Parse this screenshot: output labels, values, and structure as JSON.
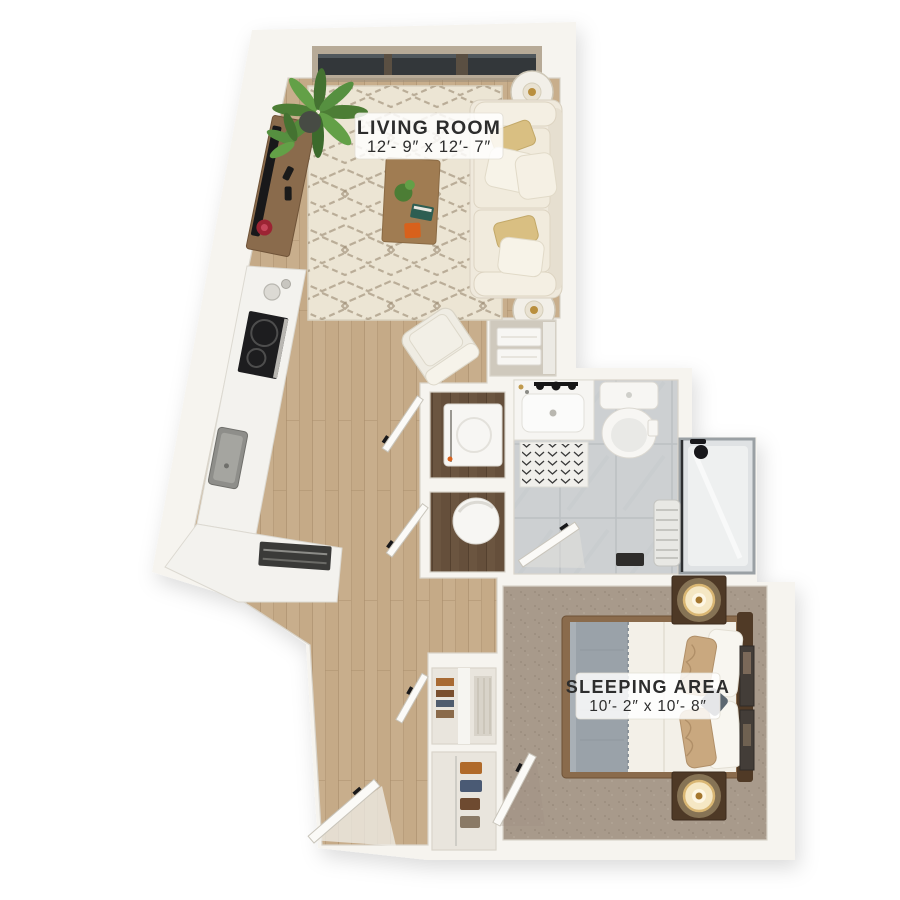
{
  "labels": {
    "living_room": {
      "name": "LIVING ROOM",
      "size": "12′- 9″ x 12′- 7″"
    },
    "sleeping_area": {
      "name": "SLEEPING AREA",
      "size": "10′- 2″ x 10′- 8″"
    }
  },
  "colors": {
    "background": "#ffffff",
    "wall": "#f6f4ef",
    "wall_edge": "#d9d4ca",
    "wood_floor": "#c8ae8c",
    "wood_seam": "#ab906e",
    "rug": "#ece5d4",
    "rug_pattern": "#9b8a72",
    "carpet": "#a89a8b",
    "carpet_dot": "#968878",
    "tile": "#cdd0d2",
    "tile_grout": "#bcc0c3",
    "counter": "#f3f2ee",
    "appliance_dark": "#1d1d1f",
    "fixture_white": "#f7f6f3",
    "furniture_wood": "#8a6b4c",
    "dark_wood": "#503a26",
    "niche_wood": "#6b5540",
    "sofa": "#efe9dc",
    "pillow_gold": "#d9bf82",
    "blanket_gray": "#9aa2a9",
    "pillow_tan": "#c9a87f",
    "plant_green": "#4c7d35",
    "accent_orange": "#d8611c",
    "accent_red": "#9c2433",
    "lamp_gold": "#d9b673",
    "glass_dark": "#33373a",
    "window_frame": "#b7aa97",
    "label_text": "#2d2d2d"
  },
  "objects": [
    "window-wall",
    "potted-plant",
    "tv-console",
    "television",
    "area-rug",
    "coffee-table",
    "sofa",
    "throw-pillows",
    "side-tables-with-lamps",
    "armchair",
    "kitchen-counter",
    "cooktop",
    "kitchen-sink",
    "dishwasher",
    "washer-closet",
    "laundry-basket-closet",
    "linen-closet",
    "bathroom-vanity",
    "toilet",
    "bath-mat",
    "walk-in-shower",
    "towel",
    "bed",
    "gray-blanket",
    "nightstands-with-lamps",
    "wall-art",
    "reach-in-closet",
    "shoe-closet",
    "entry-door",
    "interior-doors"
  ]
}
